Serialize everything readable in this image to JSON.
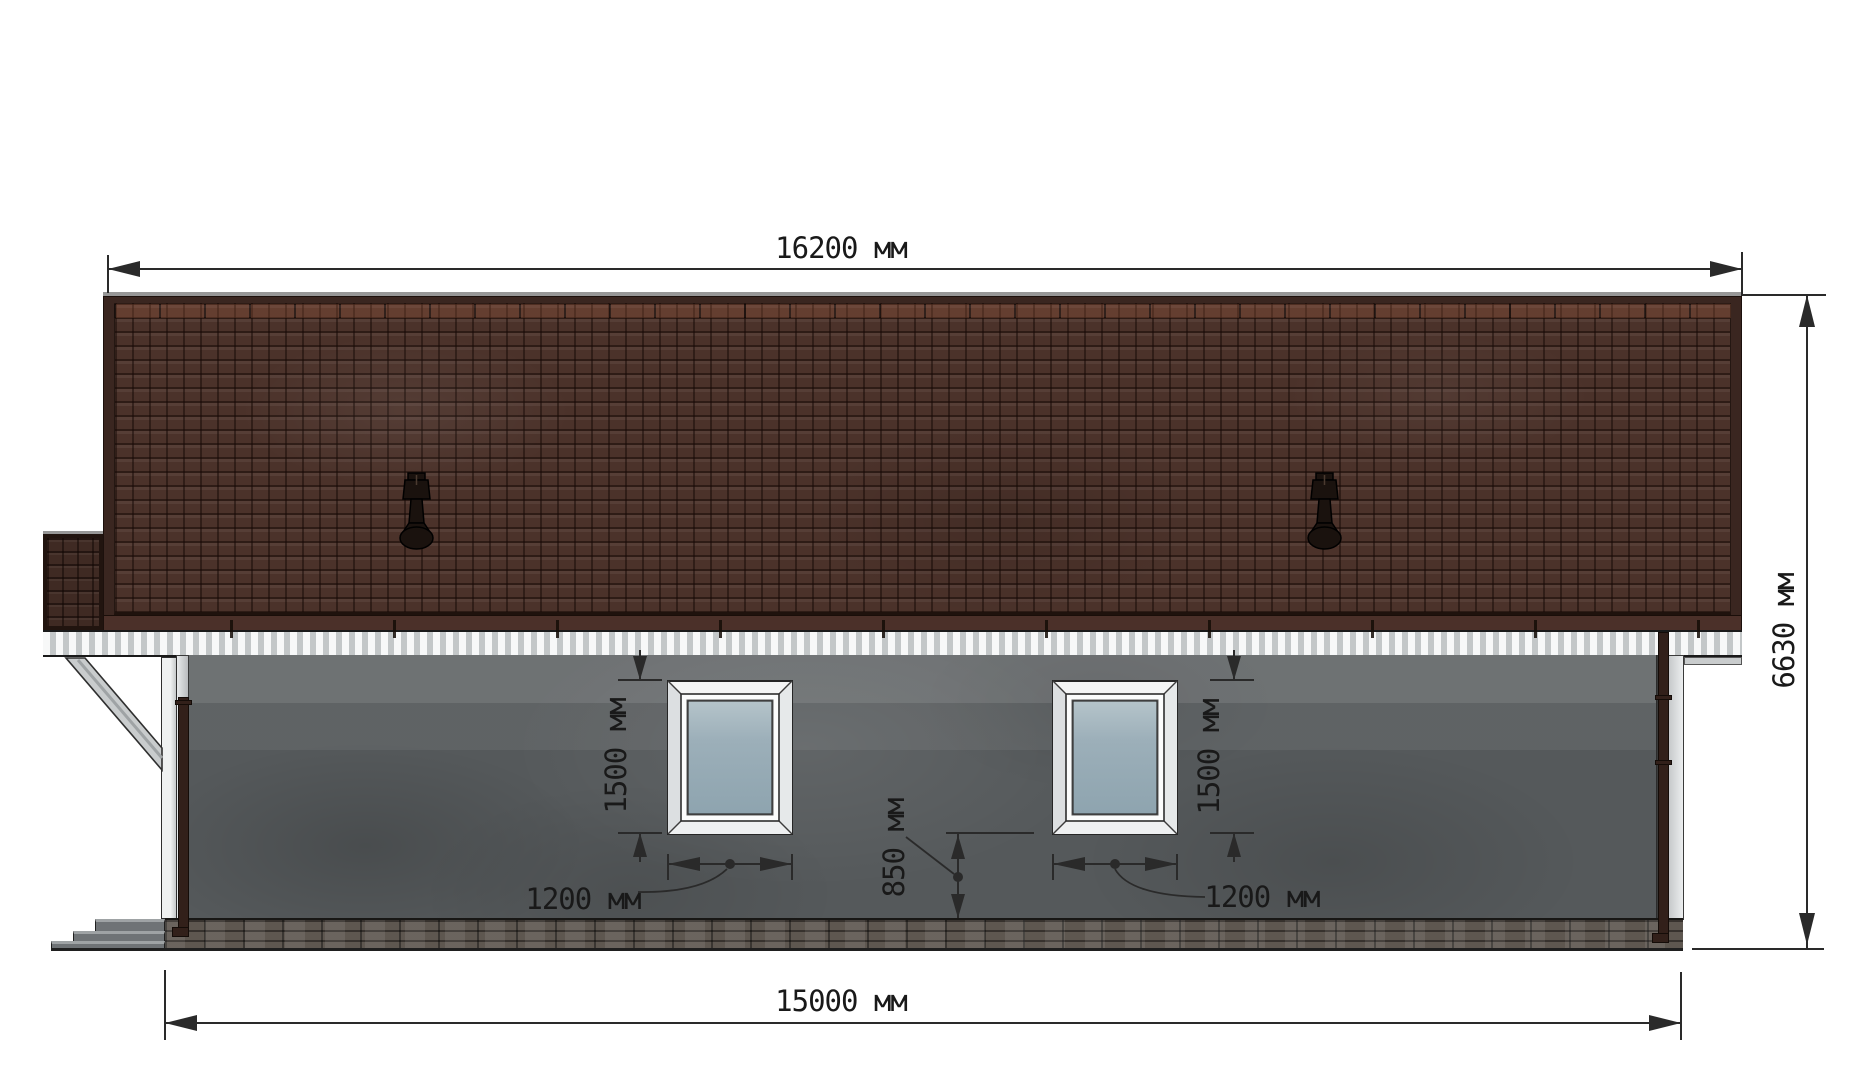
{
  "labels": {
    "roof_length": "16200 мм",
    "overall_height": "6630 мм",
    "foundation_length": "15000 мм",
    "left_window_height": "1500 мм",
    "left_window_width": "1200 мм",
    "right_window_height": "1500 мм",
    "right_window_width": "1200 мм",
    "sill_height": "850 мм"
  },
  "colors": {
    "roof_tile": "#4b322a",
    "roof_border": "#3a2620",
    "roof_eave": "#4b3029",
    "porch_tile": "#3f2a23",
    "fascia_light": "#f7f8f8",
    "fascia_shade": "#c3c7c8",
    "wall": "#55595b",
    "brick": "#5e5750",
    "window_frame": "#f4f5f5",
    "glass_top": "#b5c4ca",
    "glass_bottom": "#8ea4af",
    "downspout": "#32201a",
    "step": "#6f7376",
    "step_top": "#9fa3a5",
    "dimension_line": "#2a2a2a"
  }
}
